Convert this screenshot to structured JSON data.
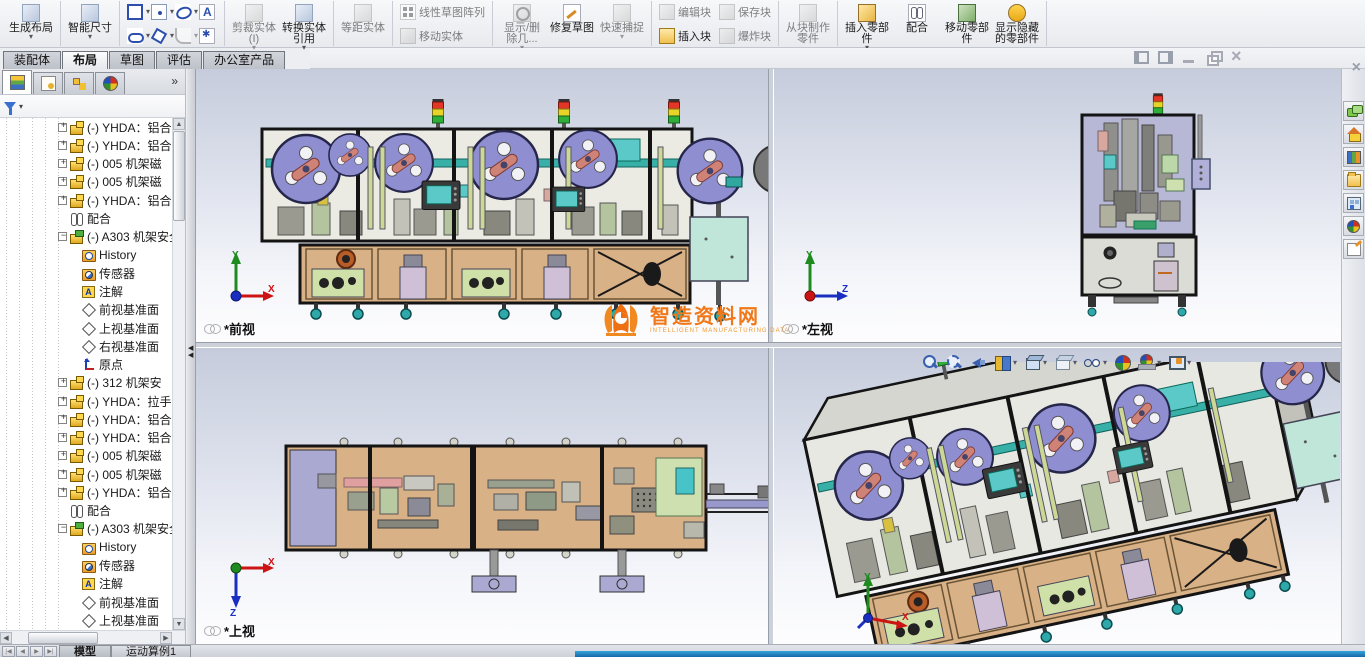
{
  "colors": {
    "accent_orange": "#f07818",
    "reel_purple": "#8e8ed0",
    "cabinet_tan": "#d9b186",
    "screen_teal": "#5cc9c9",
    "status_blue": "#1f74b4"
  },
  "tabs": [
    {
      "label": "装配体",
      "cls": ""
    },
    {
      "label": "布局",
      "cls": "active"
    },
    {
      "label": "草图",
      "cls": ""
    },
    {
      "label": "评估",
      "cls": ""
    },
    {
      "label": "办公室产品",
      "cls": ""
    }
  ],
  "toolbar": {
    "g1": [
      {
        "label": "生成布局",
        "cls": "big caret",
        "icon": "ic-makelayout"
      }
    ],
    "g2": [
      {
        "label": "智能尺寸",
        "cls": "big caret",
        "icon": "ic-smartdim"
      }
    ],
    "g3": [
      {
        "cls": "caret",
        "icon": "ic-rect"
      },
      {
        "cls": "caret",
        "icon": "ic-centerpt"
      },
      {
        "cls": "caret",
        "icon": "ic-ellipse"
      },
      {
        "cls": "",
        "icon": "ic-sktext"
      },
      {
        "cls": "caret",
        "icon": "ic-slot"
      },
      {
        "cls": "caret",
        "icon": "ic-polygon"
      },
      {
        "cls": "caret disabled",
        "icon": "ic-fillet"
      },
      {
        "cls": "",
        "icon": "ic-point"
      }
    ],
    "g4": [
      {
        "label": "剪裁实体(I)",
        "cls": "big caret disabled",
        "icon": "ic-trim"
      },
      {
        "label": "转换实体引用",
        "cls": "big caret",
        "icon": "ic-convert"
      }
    ],
    "g5": [
      {
        "label": "等距实体",
        "cls": "big disabled",
        "icon": "ic-offset"
      }
    ],
    "g6": [
      {
        "label": "线性草图阵列",
        "cls": "disabled",
        "icon": "ic-linpattern"
      },
      {
        "label": "移动实体",
        "cls": "disabled",
        "icon": "ic-move"
      }
    ],
    "g7": [
      {
        "label": "显示/删除几...",
        "cls": "big caret disabled",
        "icon": "ic-relations"
      },
      {
        "label": "修复草图",
        "cls": "big",
        "icon": "ic-repair"
      },
      {
        "label": "快速捕捉",
        "cls": "big caret disabled",
        "icon": "ic-snap"
      }
    ],
    "g8": [
      {
        "label": "编辑块",
        "cls": "disabled",
        "icon": "ic-editblock"
      },
      {
        "label": "保存块",
        "cls": "disabled",
        "icon": "ic-saveblock"
      },
      {
        "label": "插入块",
        "cls": "",
        "icon": "ic-insertblock"
      },
      {
        "label": "爆炸块",
        "cls": "disabled",
        "icon": "ic-explodeblock"
      }
    ],
    "g9": [
      {
        "label": "从块制作零件",
        "cls": "big disabled",
        "icon": "ic-makepart"
      }
    ],
    "g10": [
      {
        "label": "插入零部件",
        "cls": "big caret",
        "icon": "ic-insertcomp"
      },
      {
        "label": "配合",
        "cls": "big",
        "icon": "ic-mate"
      },
      {
        "label": "移动零部件",
        "cls": "big",
        "icon": "ic-movecomp"
      },
      {
        "label": "显示隐藏的零部件",
        "cls": "big",
        "icon": "ic-showhidden"
      }
    ]
  },
  "panel": {
    "tabs": [
      {
        "cls": "active",
        "icon": "featuremanager-icon"
      },
      {
        "cls": "",
        "icon": "propertymanager-icon"
      },
      {
        "cls": "",
        "icon": "configurationmanager-icon"
      },
      {
        "cls": "",
        "icon": "displaymanager-icon"
      }
    ],
    "overflow": "»"
  },
  "tree": {
    "items": [
      {
        "label": "(-) YHDA：铝合",
        "cls": "ind3 exp-plus ic-part"
      },
      {
        "label": "(-) YHDA：铝合",
        "cls": "ind3 exp-plus ic-part"
      },
      {
        "label": "(-) 005 机架磁",
        "cls": "ind3 exp-plus ic-part"
      },
      {
        "label": "(-) 005 机架磁",
        "cls": "ind3 exp-plus ic-part"
      },
      {
        "label": "(-) YHDA：铝合",
        "cls": "ind3 exp-plus ic-part"
      },
      {
        "label": "配合",
        "cls": "ind3 exp-none ic-mates"
      },
      {
        "label": "(-) A303 机架安全",
        "cls": "ind3 exp-minus ic-assembly"
      },
      {
        "label": "History",
        "cls": "ind4 exp-none ic-history"
      },
      {
        "label": "传感器",
        "cls": "ind4 exp-none ic-sensors"
      },
      {
        "label": "注解",
        "cls": "ind4 exp-none ic-annotations"
      },
      {
        "label": "前视基准面",
        "cls": "ind4 exp-none ic-plane"
      },
      {
        "label": "上视基准面",
        "cls": "ind4 exp-none ic-plane"
      },
      {
        "label": "右视基准面",
        "cls": "ind4 exp-none ic-plane"
      },
      {
        "label": "原点",
        "cls": "ind4 exp-none ic-origin"
      },
      {
        "label": "(-) 312 机架安",
        "cls": "ind3 exp-plus ic-part"
      },
      {
        "label": "(-) YHDA：拉手",
        "cls": "ind3 exp-plus ic-part"
      },
      {
        "label": "(-) YHDA：铝合",
        "cls": "ind3 exp-plus ic-part"
      },
      {
        "label": "(-) YHDA：铝合",
        "cls": "ind3 exp-plus ic-part"
      },
      {
        "label": "(-) 005 机架磁",
        "cls": "ind3 exp-plus ic-part"
      },
      {
        "label": "(-) 005 机架磁",
        "cls": "ind3 exp-plus ic-part"
      },
      {
        "label": "(-) YHDA：铝合",
        "cls": "ind3 exp-plus ic-part"
      },
      {
        "label": "配合",
        "cls": "ind3 exp-none ic-mates"
      },
      {
        "label": "(-) A303 机架安全",
        "cls": "ind3 exp-minus ic-assembly"
      },
      {
        "label": "History",
        "cls": "ind4 exp-none ic-history"
      },
      {
        "label": "传感器",
        "cls": "ind4 exp-none ic-sensors"
      },
      {
        "label": "注解",
        "cls": "ind4 exp-none ic-annotations"
      },
      {
        "label": "前视基准面",
        "cls": "ind4 exp-none ic-plane"
      },
      {
        "label": "上视基准面",
        "cls": "ind4 exp-none ic-plane"
      }
    ]
  },
  "views": {
    "front": {
      "label": "*前视"
    },
    "left": {
      "label": "*左视"
    },
    "top": {
      "label": "*上视"
    }
  },
  "headsup": {
    "icons": [
      {
        "icon": "zoom-fit-icon",
        "cls": ""
      },
      {
        "icon": "zoom-area-icon",
        "cls": ""
      },
      {
        "icon": "previous-view-icon",
        "cls": ""
      },
      {
        "icon": "section-view-icon",
        "cls": "caret"
      },
      {
        "icon": "view-orientation-icon",
        "cls": "caret"
      },
      {
        "icon": "display-style-icon",
        "cls": "caret"
      },
      {
        "icon": "hide-show-items-icon",
        "cls": "caret"
      },
      {
        "icon": "edit-appearance-icon",
        "cls": ""
      },
      {
        "icon": "apply-scene-icon",
        "cls": "caret"
      },
      {
        "icon": "view-settings-icon",
        "cls": "caret"
      }
    ]
  },
  "watermark": {
    "title": "智造资料网",
    "subtitle": "INTELLIGENT MANUFACTURING DATA"
  },
  "windowControls": [
    {
      "icon": "pane-left-icon"
    },
    {
      "icon": "pane-right-icon"
    },
    {
      "icon": "minimize-icon"
    },
    {
      "icon": "restore-icon"
    },
    {
      "icon": "close-icon"
    }
  ],
  "taskpane": {
    "close": "×",
    "icons": [
      {
        "icon": "resources-icon"
      },
      {
        "icon": "home-icon"
      },
      {
        "icon": "design-library-icon"
      },
      {
        "icon": "file-explorer-icon"
      },
      {
        "icon": "view-palette-icon"
      },
      {
        "icon": "appearances-icon"
      },
      {
        "icon": "custom-properties-icon"
      }
    ]
  },
  "statusbar": {
    "nav": [
      {
        "g": "|◀"
      },
      {
        "g": "◀"
      },
      {
        "g": "▶"
      },
      {
        "g": "▶|"
      }
    ],
    "tabs": [
      {
        "label": "模型",
        "cls": "active"
      },
      {
        "label": "运动算例1",
        "cls": ""
      }
    ]
  }
}
